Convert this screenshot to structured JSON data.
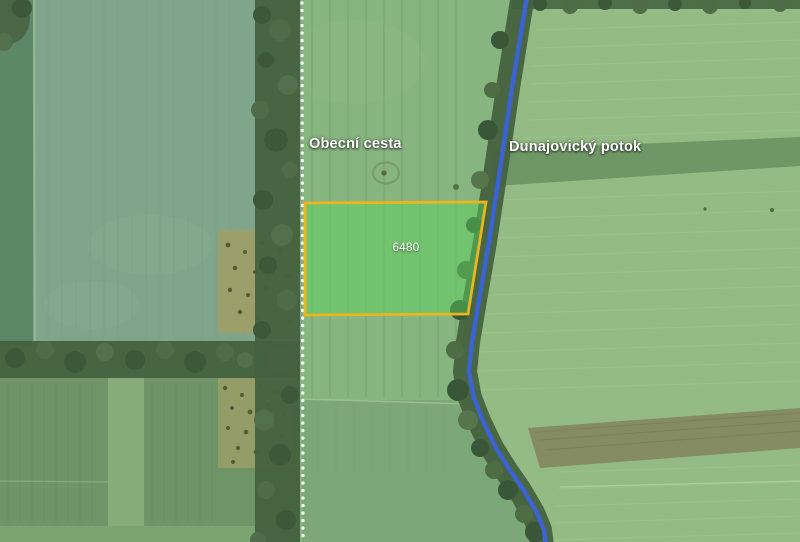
{
  "map": {
    "description": "Aerial cadastral map with highlighted parcel between a field road and a stream",
    "labels": {
      "road": "Obecní cesta",
      "stream": "Dunajovický potok"
    },
    "parcel": {
      "number": "6480",
      "border_color": "#EBB51E",
      "fill_color": "#58D55D",
      "fill_opacity": "0.45"
    },
    "colors": {
      "stream_blue": "#3B63D6",
      "road_dots": "#FFFFFF",
      "label_text": "#FFFFFF",
      "field_light_green": "#87B57F",
      "field_teal_green": "#7FA68B",
      "tree_dark_green": "#45613F"
    }
  }
}
